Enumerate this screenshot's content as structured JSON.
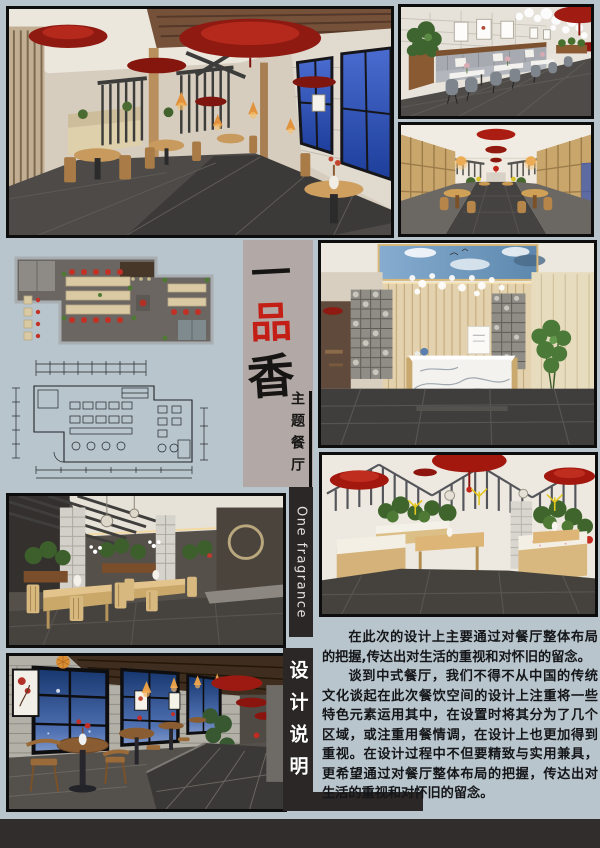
{
  "title": {
    "char1": "一",
    "char2": "品",
    "char3": "香",
    "subtitle": "主题餐厅",
    "english": "One fragrance",
    "section": "设计说明"
  },
  "description": {
    "para1": "在此次的设计上主要通过对餐厅整体布局的把握,传达出对生活的重视和对怀旧的留念。",
    "para2": "谈到中式餐厅，我们不得不从中国的传统文化谈起在此次餐饮空间的设计上注重将一些特色元素运用其中，在设置时将其分为了几个区域，或注重用餐情调，在设计上也更加得到重视。在设计过程中不但要精致与实用兼具，更希望通过对餐厅整体布局的把握，传达出对生活的重视和对怀旧的留念。"
  },
  "colors": {
    "background": "#b9c5cc",
    "title_panel": "#b2a9a6",
    "accent_red": "#c41f16",
    "strip_black": "#2b2726",
    "footer_black": "#312d2c",
    "ink": "#161514"
  }
}
